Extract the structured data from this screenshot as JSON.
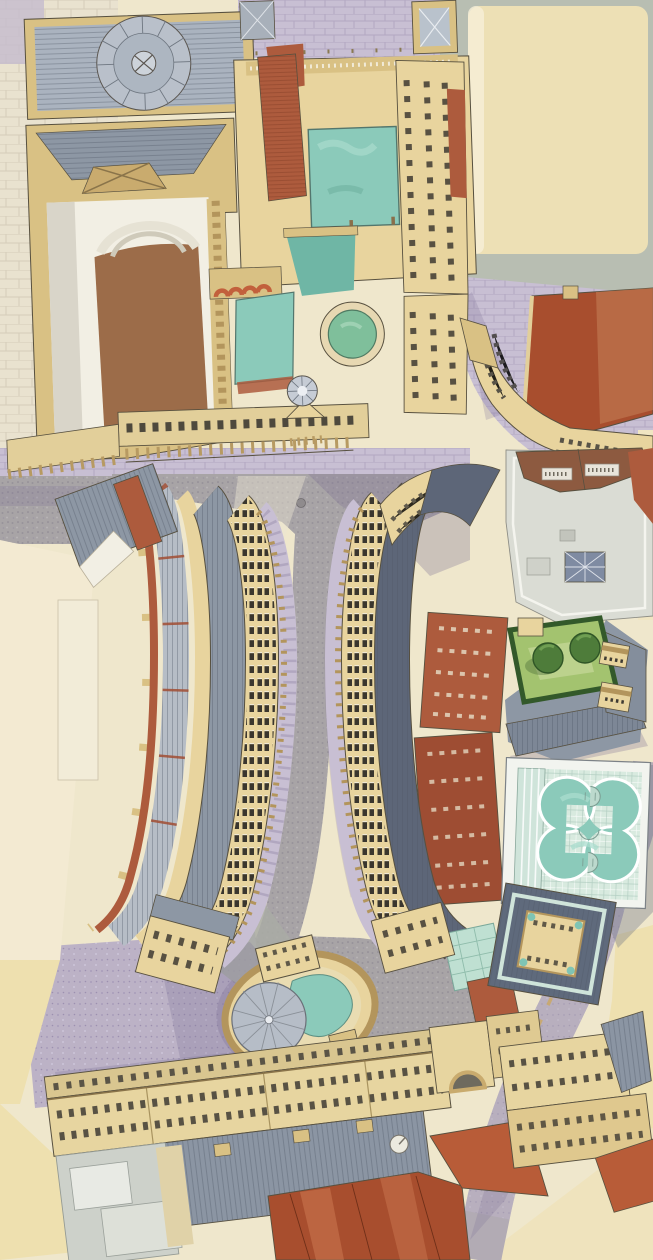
{
  "artwork": {
    "kind": "watercolor-aerial-architectural-illustration",
    "view": "birds-eye-cutaway",
    "subject": "historic-spa-quarter"
  },
  "palette": {
    "paper": "#efe7cc",
    "pale_block": "#eee0af",
    "pale_block2": "#f3ead2",
    "stone_light": "#e8d49e",
    "stone_mid": "#d9c184",
    "stone_dark": "#b3955c",
    "ink": "#57503f",
    "white_wall": "#f2efe4",
    "slate_light": "#b6bdc6",
    "slate_mid": "#8d97a4",
    "slate_dark": "#6d7888",
    "navy_roof": "#5d6678",
    "brick_red": "#ad5b3d",
    "brick_dark": "#9e4d33",
    "roof_red": "#a84e2e",
    "roof_red_light": "#c06a48",
    "pool_teal": "#8bcaba",
    "pool_teal_deep": "#6fb6a5",
    "pool_green": "#7fbf9b",
    "glass_mint": "#d8eadf",
    "glass_frame": "#f2f4ef",
    "lawn_green": "#a3c36f",
    "tree_green": "#4e7c3a",
    "hedge_green": "#33592a",
    "lavender": "#c8bfd3",
    "lavender_dark": "#b1a6c0",
    "street_grey": "#a8a4a6",
    "street_grey_dark": "#918d90",
    "green_grey": "#b8beb2",
    "shadow_violet": "#7e7296",
    "floor_brown": "#9c6c49",
    "modern_grey": "#dadcd4",
    "court_grey": "#cdd1ca"
  },
  "features": [
    {
      "name": "great-bath",
      "kind": "pool",
      "water": "#8bcaba"
    },
    {
      "name": "kings-bath",
      "kind": "pool",
      "water": "#8bcaba"
    },
    {
      "name": "circular-bath",
      "kind": "pool",
      "water": "#7fbf9b"
    },
    {
      "name": "spa-quatrefoil-pool",
      "kind": "pool",
      "water": "#8bcaba"
    },
    {
      "name": "cross-bath-pool",
      "kind": "pool",
      "water": "#8bcaba"
    },
    {
      "name": "concert-hall-dome",
      "kind": "dome",
      "color": "#b9c0ca"
    },
    {
      "name": "west-colonnade",
      "kind": "colonnade",
      "columns": 15
    },
    {
      "name": "east-colonnade",
      "kind": "colonnade",
      "columns": 15
    },
    {
      "name": "garden-courtyard",
      "kind": "garden",
      "trees": 2
    }
  ]
}
